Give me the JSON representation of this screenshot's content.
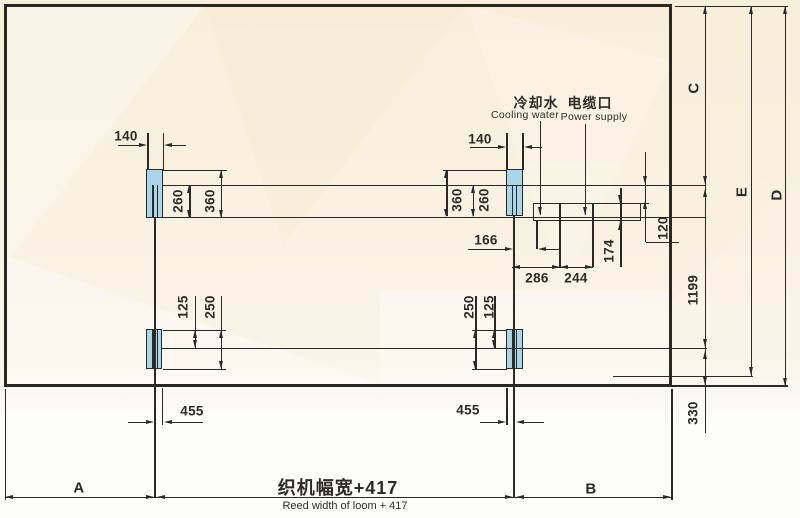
{
  "connections": {
    "cooling": {
      "cn": "冷却水",
      "en": "Cooling water"
    },
    "power": {
      "cn": "电缆口",
      "en": "Power supply"
    }
  },
  "dimensions": {
    "top_left": {
      "w140": "140",
      "h260": "260",
      "h360": "360"
    },
    "top_right": {
      "w140": "140",
      "h260": "260",
      "h360": "360"
    },
    "bottom_left": {
      "h125": "125",
      "h250": "250",
      "w455": "455"
    },
    "bottom_right": {
      "h125": "125",
      "h250": "250",
      "w455": "455"
    },
    "utility": {
      "d166": "166",
      "d286": "286",
      "d244": "244",
      "d174": "174",
      "d120": "120"
    },
    "right_column": {
      "c": "C",
      "e": "E",
      "d": "D",
      "d1199": "1199",
      "d330": "330"
    }
  },
  "footer": {
    "a": "A",
    "b": "B",
    "width_cn": "织机幅宽+417",
    "width_en": "Reed width of loom + 417"
  },
  "colors": {
    "foot_fill": "#a9d7e9",
    "line": "#2b2925",
    "bg_cream": "#f8f1e0"
  }
}
